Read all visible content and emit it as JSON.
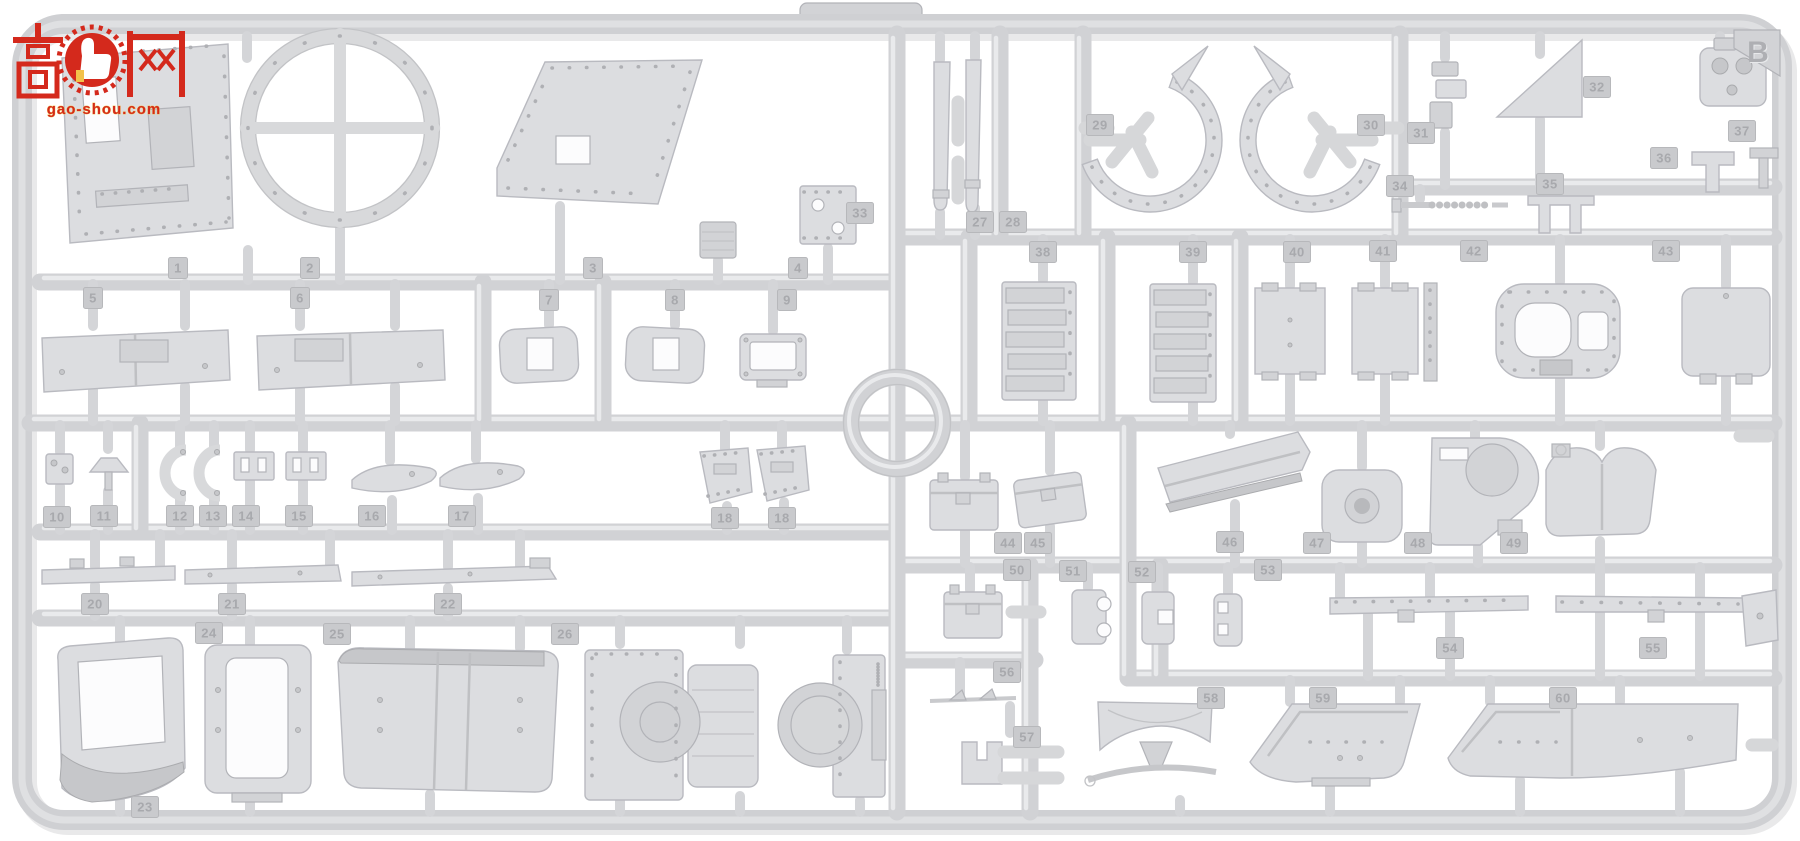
{
  "scene": {
    "background": "#ffffff"
  },
  "sprue": {
    "letter": "B",
    "plastic_color": "#d4d5d7",
    "highlight_color": "#e9eaec",
    "shadow_color": "#b0b1b4",
    "tag_fill": "#c9cacd",
    "tag_text_color": "#a8a9ad"
  },
  "watermark": {
    "char_left": "高",
    "char_right": "网",
    "logo": "thumb-up-gear-badge",
    "url": "gao-shou.com",
    "red": "#d4291c",
    "gold": "#f3c24a"
  },
  "part_tags": [
    {
      "n": "1",
      "x": 178,
      "y": 268
    },
    {
      "n": "2",
      "x": 310,
      "y": 268
    },
    {
      "n": "3",
      "x": 593,
      "y": 268
    },
    {
      "n": "4",
      "x": 798,
      "y": 268
    },
    {
      "n": "5",
      "x": 93,
      "y": 298
    },
    {
      "n": "6",
      "x": 300,
      "y": 298
    },
    {
      "n": "7",
      "x": 549,
      "y": 300
    },
    {
      "n": "8",
      "x": 675,
      "y": 300
    },
    {
      "n": "9",
      "x": 787,
      "y": 300
    },
    {
      "n": "10",
      "x": 57,
      "y": 517
    },
    {
      "n": "11",
      "x": 104,
      "y": 516
    },
    {
      "n": "12",
      "x": 180,
      "y": 516
    },
    {
      "n": "13",
      "x": 213,
      "y": 516
    },
    {
      "n": "14",
      "x": 246,
      "y": 516
    },
    {
      "n": "15",
      "x": 299,
      "y": 516
    },
    {
      "n": "16",
      "x": 372,
      "y": 516
    },
    {
      "n": "17",
      "x": 462,
      "y": 516
    },
    {
      "n": "18",
      "x": 725,
      "y": 518
    },
    {
      "n": "18",
      "x": 782,
      "y": 518
    },
    {
      "n": "20",
      "x": 95,
      "y": 604
    },
    {
      "n": "21",
      "x": 232,
      "y": 604
    },
    {
      "n": "22",
      "x": 448,
      "y": 604
    },
    {
      "n": "24",
      "x": 209,
      "y": 633
    },
    {
      "n": "25",
      "x": 337,
      "y": 634
    },
    {
      "n": "26",
      "x": 565,
      "y": 634
    },
    {
      "n": "23",
      "x": 145,
      "y": 807
    },
    {
      "n": "27",
      "x": 980,
      "y": 222
    },
    {
      "n": "28",
      "x": 1013,
      "y": 222
    },
    {
      "n": "29",
      "x": 1100,
      "y": 125
    },
    {
      "n": "30",
      "x": 1371,
      "y": 125
    },
    {
      "n": "31",
      "x": 1421,
      "y": 133
    },
    {
      "n": "32",
      "x": 1597,
      "y": 87
    },
    {
      "n": "33",
      "x": 860,
      "y": 213
    },
    {
      "n": "34",
      "x": 1400,
      "y": 186
    },
    {
      "n": "35",
      "x": 1550,
      "y": 184
    },
    {
      "n": "36",
      "x": 1664,
      "y": 158
    },
    {
      "n": "37",
      "x": 1742,
      "y": 131
    },
    {
      "n": "38",
      "x": 1043,
      "y": 252
    },
    {
      "n": "39",
      "x": 1193,
      "y": 252
    },
    {
      "n": "40",
      "x": 1297,
      "y": 252
    },
    {
      "n": "41",
      "x": 1383,
      "y": 251
    },
    {
      "n": "42",
      "x": 1474,
      "y": 251
    },
    {
      "n": "43",
      "x": 1666,
      "y": 251
    },
    {
      "n": "44",
      "x": 1008,
      "y": 543
    },
    {
      "n": "45",
      "x": 1038,
      "y": 543
    },
    {
      "n": "46",
      "x": 1230,
      "y": 542
    },
    {
      "n": "47",
      "x": 1317,
      "y": 543
    },
    {
      "n": "48",
      "x": 1418,
      "y": 543
    },
    {
      "n": "49",
      "x": 1514,
      "y": 543
    },
    {
      "n": "50",
      "x": 1017,
      "y": 570
    },
    {
      "n": "51",
      "x": 1073,
      "y": 571
    },
    {
      "n": "52",
      "x": 1142,
      "y": 572
    },
    {
      "n": "53",
      "x": 1268,
      "y": 570
    },
    {
      "n": "54",
      "x": 1450,
      "y": 648
    },
    {
      "n": "55",
      "x": 1653,
      "y": 648
    },
    {
      "n": "56",
      "x": 1007,
      "y": 672
    },
    {
      "n": "57",
      "x": 1027,
      "y": 737
    },
    {
      "n": "58",
      "x": 1211,
      "y": 698
    },
    {
      "n": "59",
      "x": 1323,
      "y": 698
    },
    {
      "n": "60",
      "x": 1563,
      "y": 698
    }
  ]
}
